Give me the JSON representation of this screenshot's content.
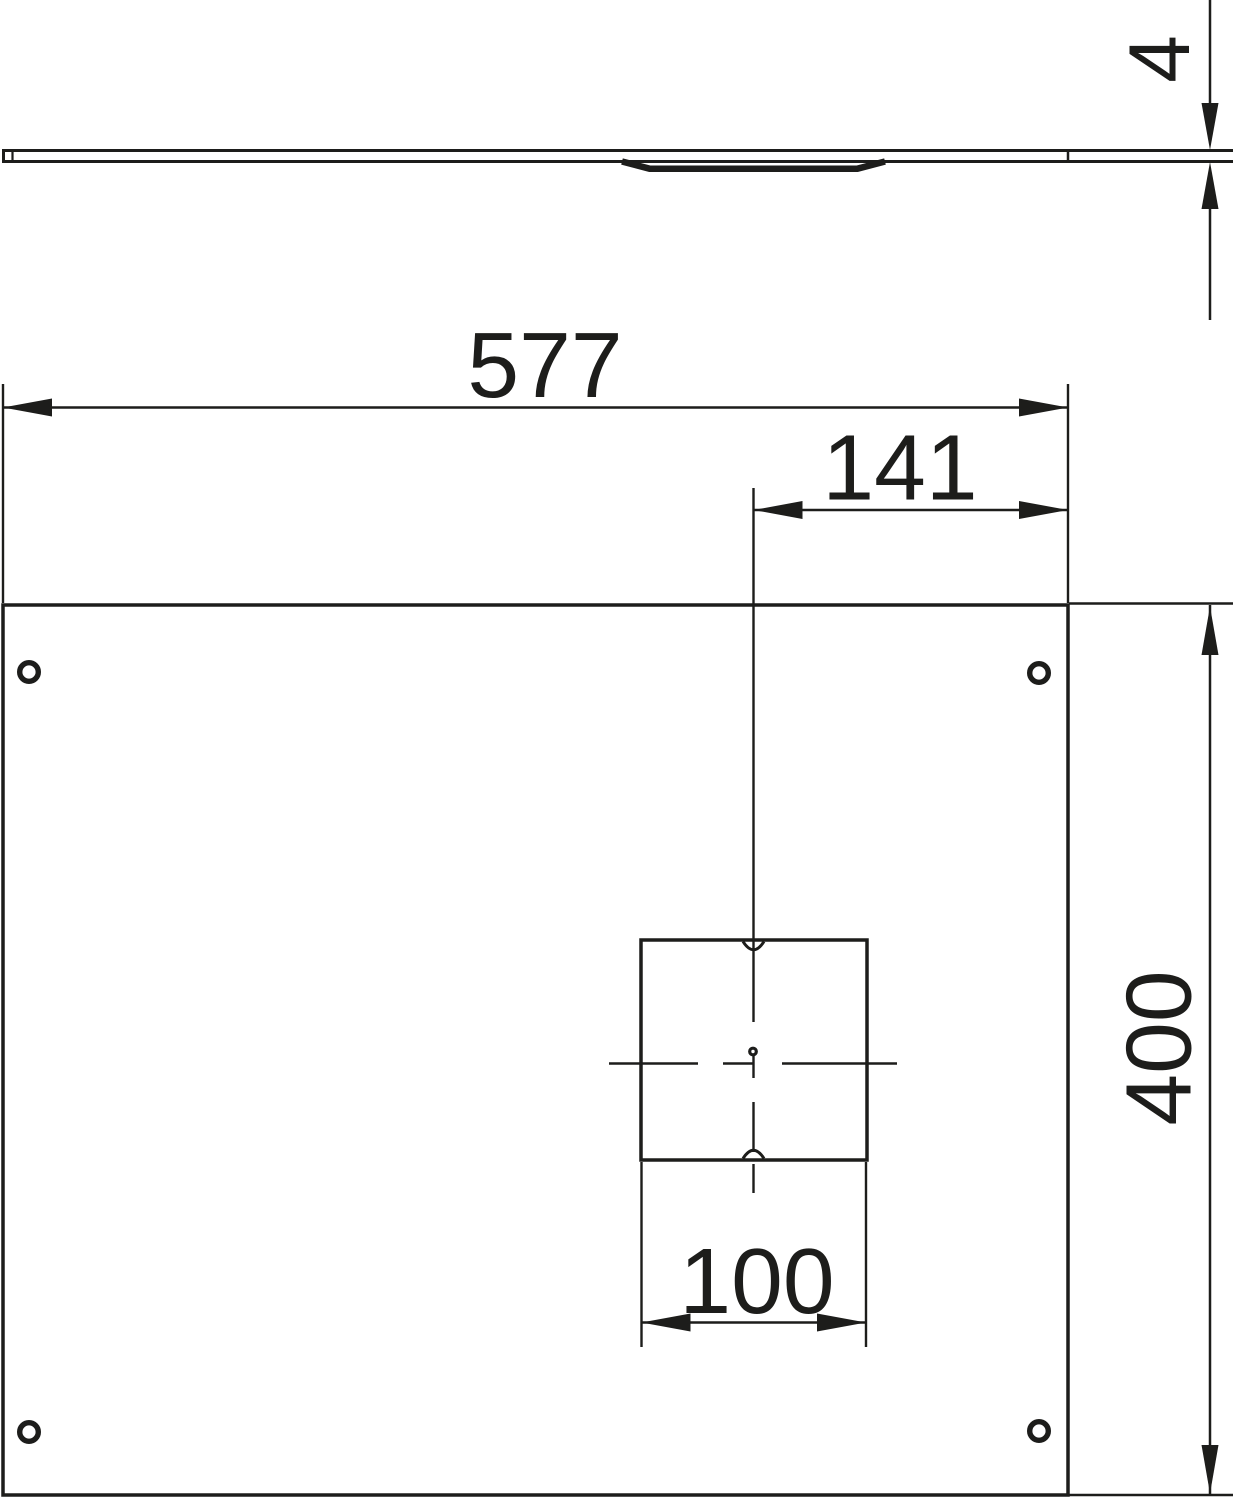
{
  "drawing": {
    "type": "technical-dimension-drawing",
    "background_color": "#ffffff",
    "line_color": "#1d1d1b",
    "views": {
      "side_view": {
        "description": "thin cover plate profile with recessed section",
        "thickness_label": "4"
      },
      "plan_view": {
        "description": "rectangular cover plate with four mounting holes and square cutout",
        "overall_width_label": "577",
        "cutout_center_offset_label": "141",
        "overall_height_label": "400",
        "cutout_width_label": "100",
        "mounting_hole_count": 4
      }
    }
  }
}
